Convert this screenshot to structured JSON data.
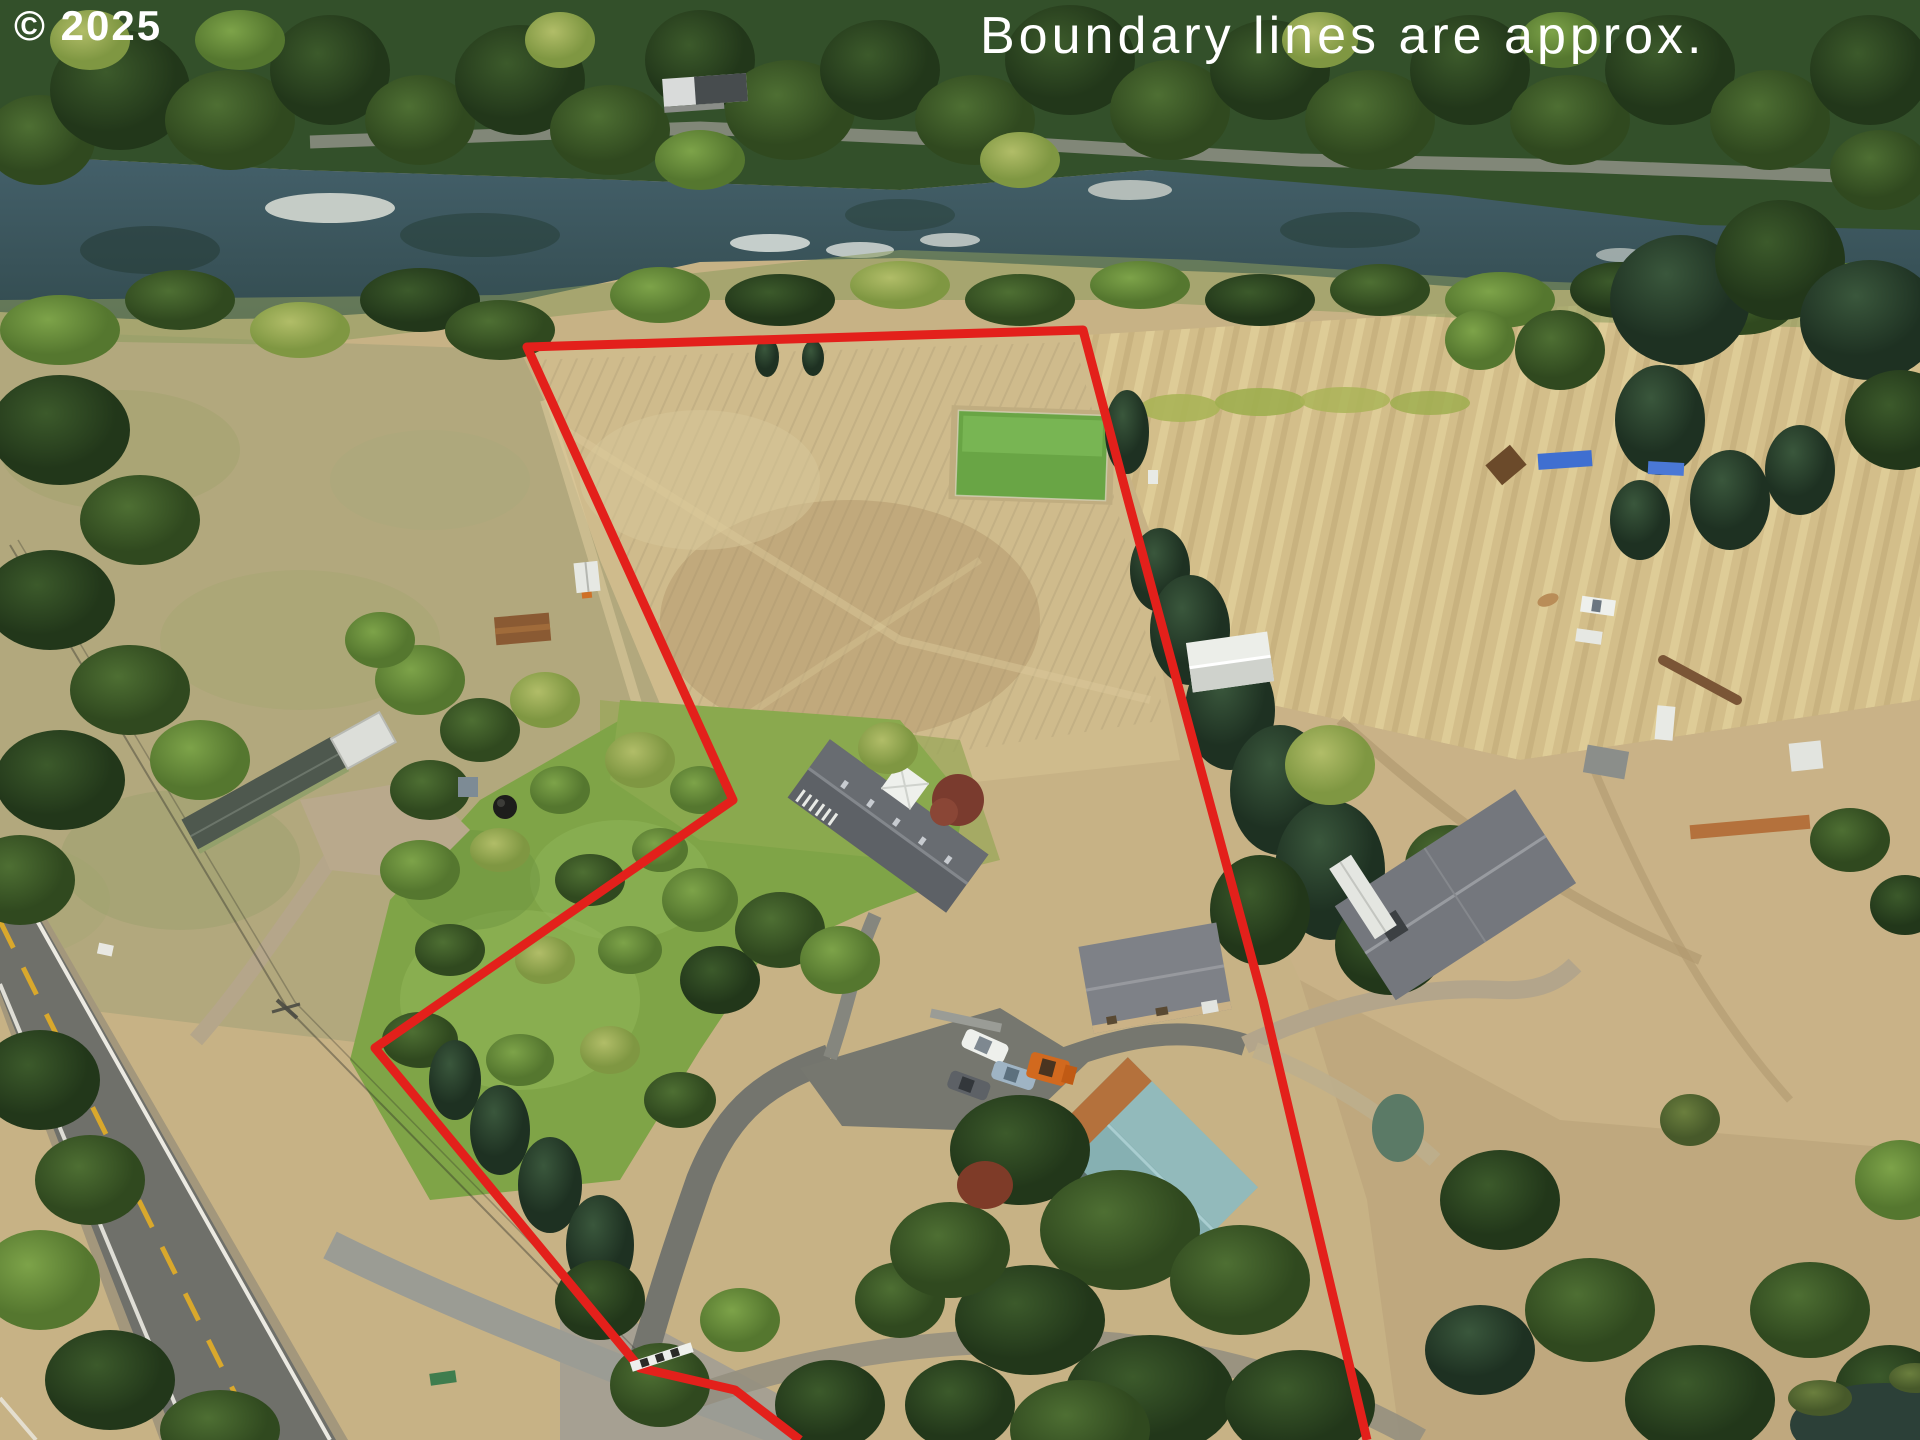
{
  "overlay": {
    "watermark": "© 2025",
    "disclaimer": "Boundary lines are approx.",
    "text_color": "#ffffff",
    "boundary": {
      "color": "#e3201b",
      "stroke_width": 9,
      "points": [
        [
          800,
          1440
        ],
        [
          735,
          1390
        ],
        [
          640,
          1368
        ],
        [
          375,
          1048
        ],
        [
          733,
          800
        ],
        [
          527,
          347
        ],
        [
          1083,
          330
        ],
        [
          1128,
          500
        ],
        [
          1263,
          1000
        ],
        [
          1367,
          1440
        ]
      ]
    }
  },
  "palette": {
    "boundary_red": "#e3201b",
    "field_tan": "#c7b285",
    "golden_field": "#d3be8a",
    "river_water": "#3d5862",
    "forest_green": "#33502a",
    "lawn_green": "#7fa447",
    "barn_teal_roof": "#86b0b2",
    "barn_trim_orange": "#b4713c",
    "asphalt_road": "#6f706a",
    "roof_gray": "#5d6166"
  }
}
